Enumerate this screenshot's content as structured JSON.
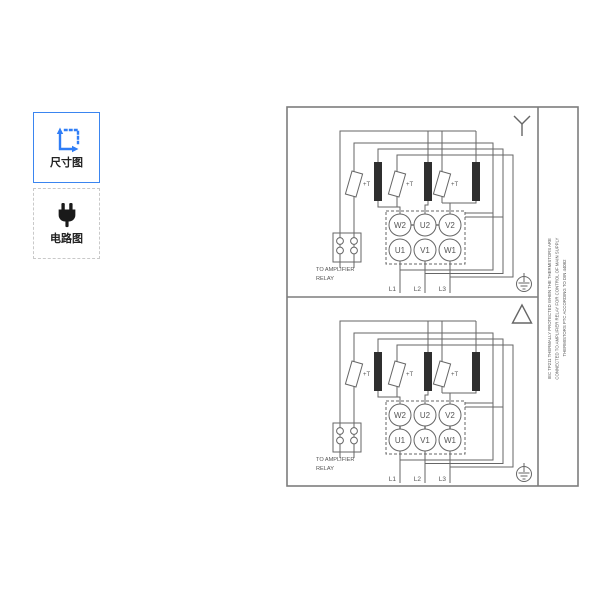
{
  "sidebar": {
    "thumbnails": [
      {
        "label": "尺寸图",
        "icon": "dimension-icon",
        "selected": true
      },
      {
        "label": "电路图",
        "icon": "plug-icon",
        "selected": false
      }
    ]
  },
  "drawing": {
    "colors": {
      "line": "#666666",
      "frame": "#7d7d7d",
      "coil_fill": "#2f2f2f",
      "accent_blue": "#2f7df6"
    },
    "terminals_top": [
      "W2",
      "U2",
      "V2"
    ],
    "terminals_bottom": [
      "U1",
      "V1",
      "W1"
    ],
    "leads": [
      "L1",
      "L2",
      "L3"
    ],
    "thermistor_label": "+T",
    "relay_note_line1": "TO AMPLIFIER",
    "relay_note_line2": "RELAY",
    "connection_symbols": {
      "top": "star-connection",
      "bottom": "delta-connection"
    },
    "side_note_lines": [
      "IEC TP211 THERMALLY PROTECTED WHEN THE THERMISTORS ARE",
      "CONNECTED TO AMPLIFIER RELAY FOR CONTROL OF MAIN SUPPLY",
      "THERMISTORS PTC ACCORDING TO DIN 44082"
    ]
  }
}
